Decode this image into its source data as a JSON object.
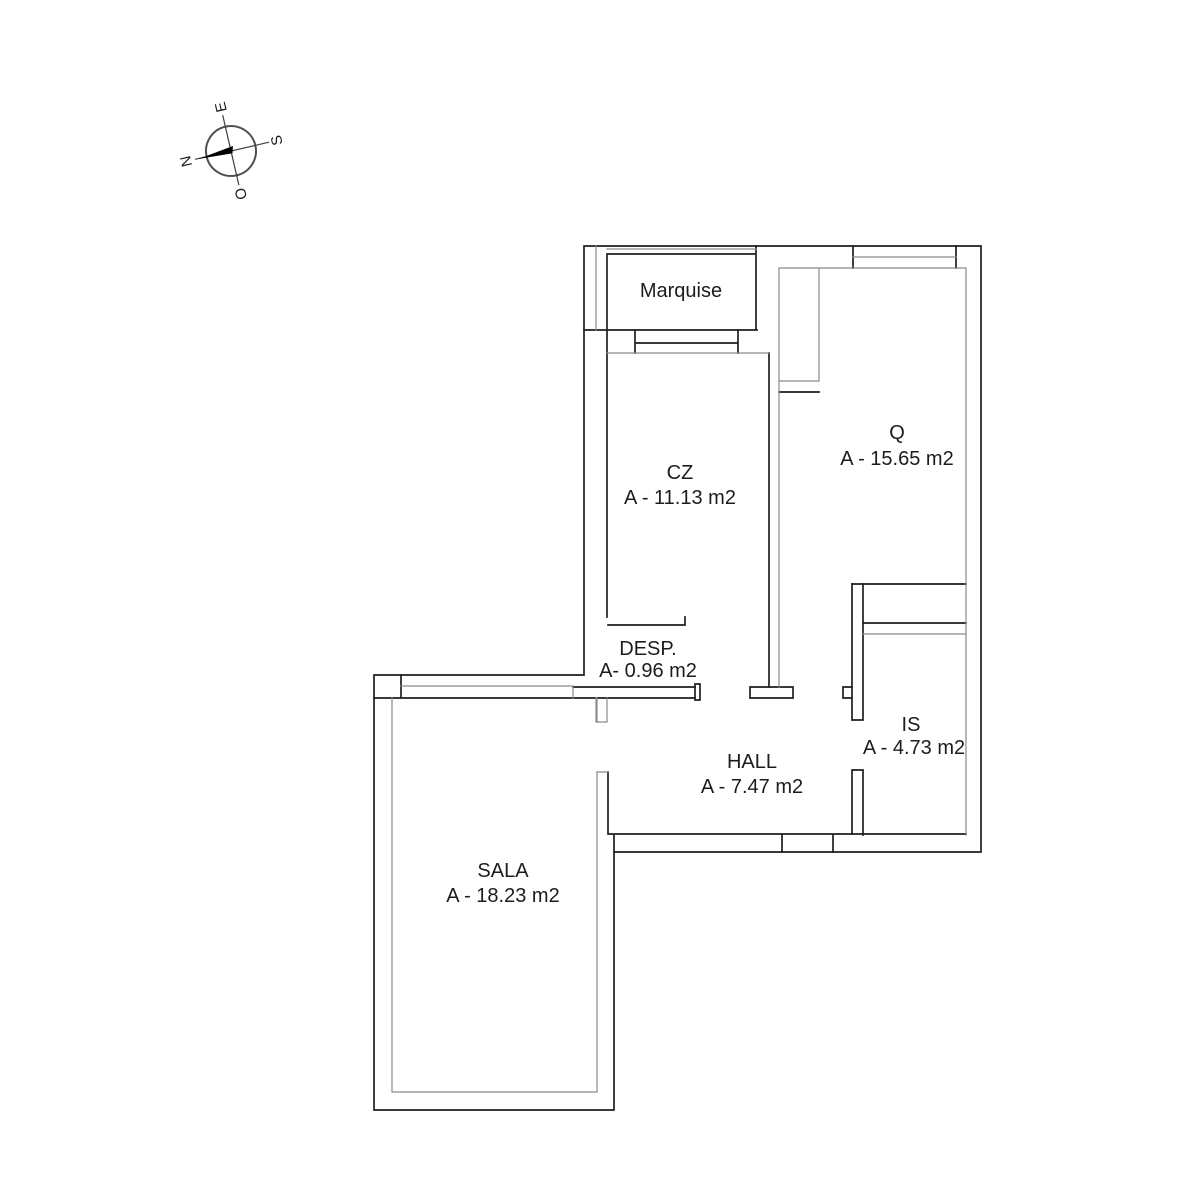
{
  "compass": {
    "n": "N",
    "e": "E",
    "s": "S",
    "o": "O"
  },
  "rooms": {
    "marquise": {
      "name": "Marquise",
      "area": ""
    },
    "cz": {
      "name": "CZ",
      "area": "A - 11.13 m2"
    },
    "q": {
      "name": "Q",
      "area": "A - 15.65 m2"
    },
    "desp": {
      "name": "DESP.",
      "area": "A- 0.96 m2"
    },
    "hall": {
      "name": "HALL",
      "area": "A - 7.47 m2"
    },
    "is": {
      "name": "IS",
      "area": "A - 4.73 m2"
    },
    "sala": {
      "name": "SALA",
      "area": "A - 18.23 m2"
    }
  },
  "colors": {
    "wall_dark": "#1f1f1f",
    "wall_light": "#8a8a8a",
    "needle": "#000000",
    "background": "#ffffff"
  }
}
